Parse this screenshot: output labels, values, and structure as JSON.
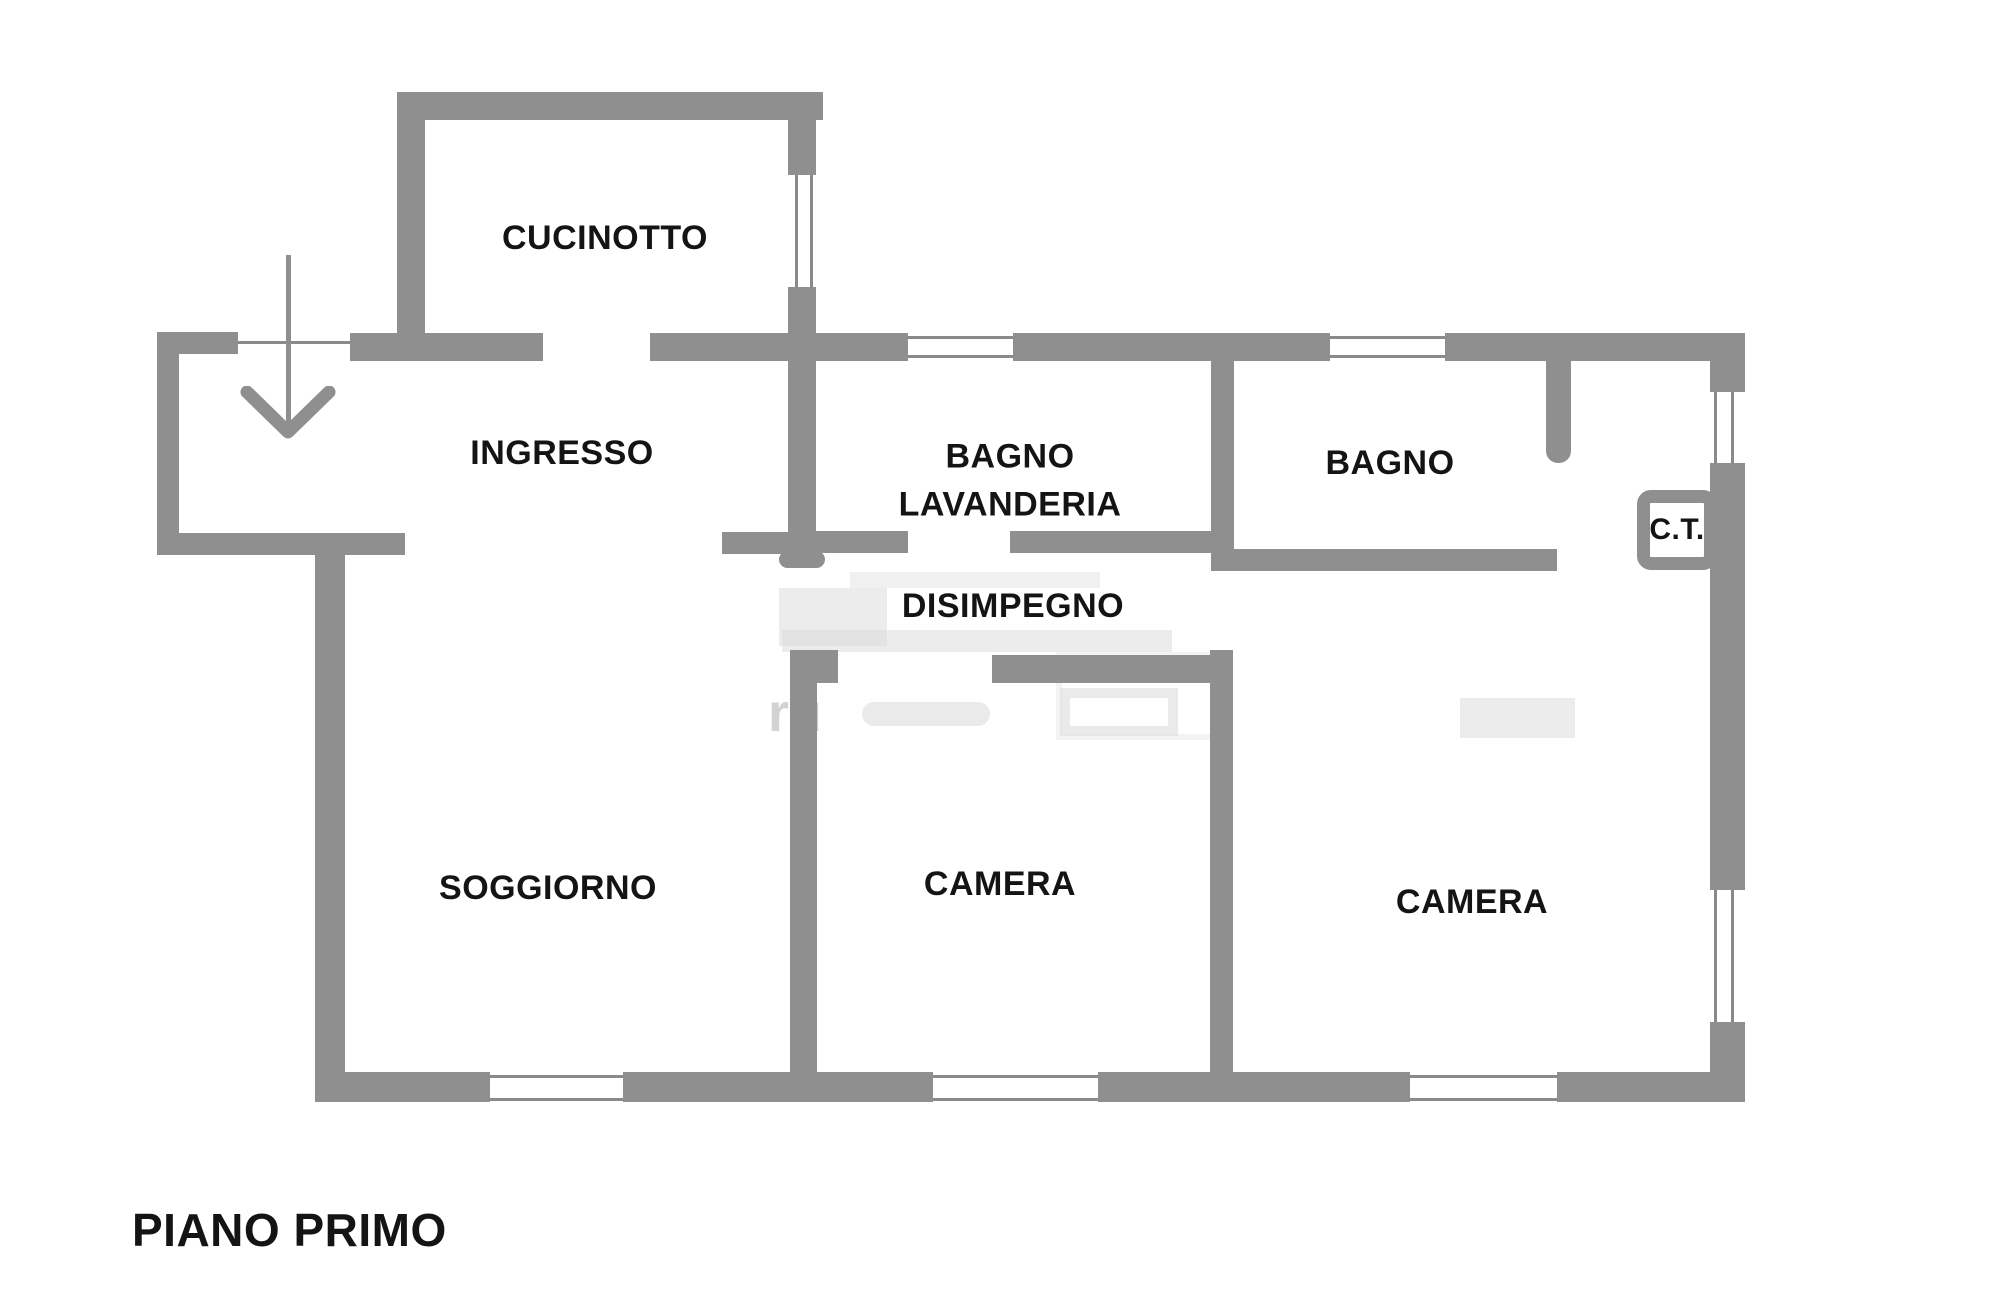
{
  "title": "PIANO PRIMO",
  "watermark_fragment": "ru",
  "colors": {
    "wall": "#8f8f8f",
    "text": "#141414",
    "watermark": "#d9d9d9",
    "background": "#ffffff"
  },
  "rooms": [
    {
      "id": "cucinotto",
      "label": "CUCINOTTO"
    },
    {
      "id": "ingresso",
      "label": "INGRESSO"
    },
    {
      "id": "bagno-lavanderia",
      "label": "BAGNO\nLAVANDERIA"
    },
    {
      "id": "bagno",
      "label": "BAGNO"
    },
    {
      "id": "ct",
      "label": "C.T."
    },
    {
      "id": "disimpegno",
      "label": "DISIMPEGNO"
    },
    {
      "id": "soggiorno",
      "label": "SOGGIORNO"
    },
    {
      "id": "camera-1",
      "label": "CAMERA"
    },
    {
      "id": "camera-2",
      "label": "CAMERA"
    }
  ]
}
